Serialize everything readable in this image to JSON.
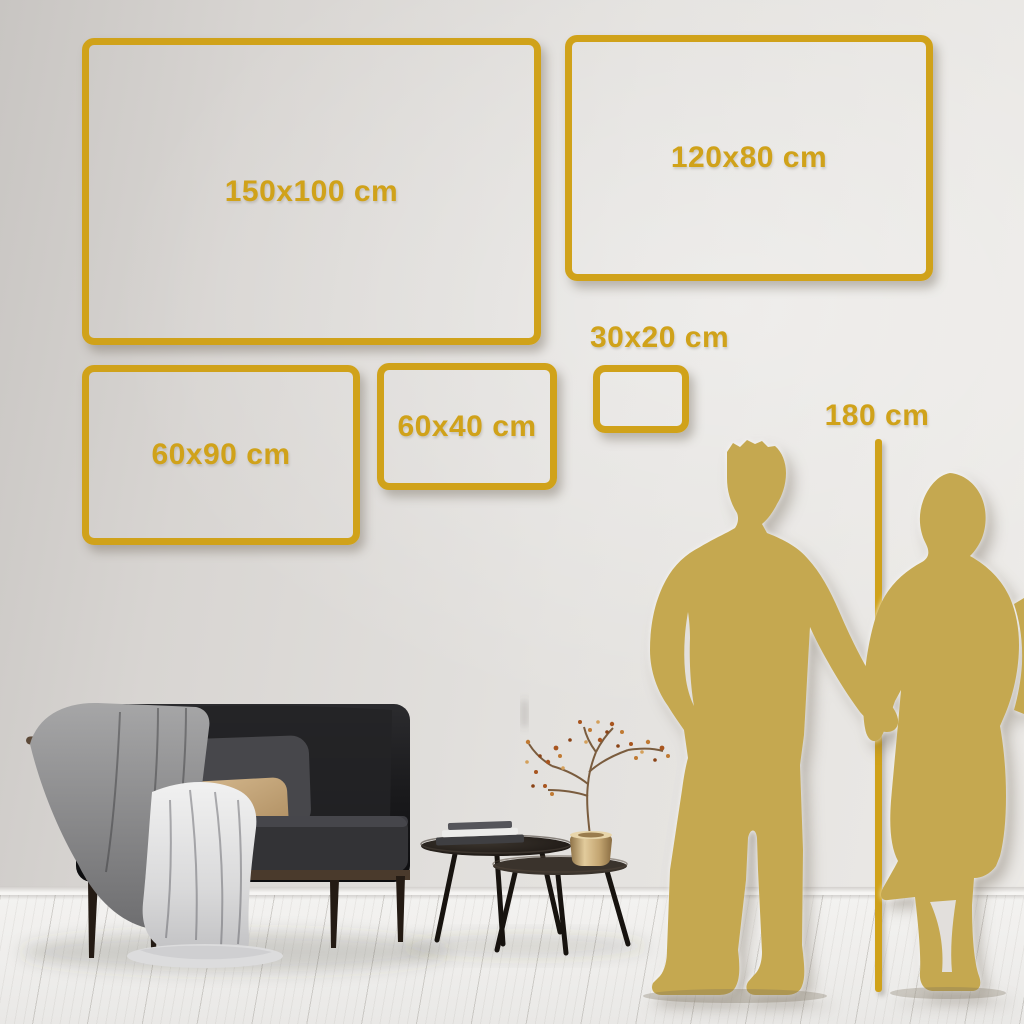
{
  "page": {
    "title": "Wall art size guide"
  },
  "size_guide": {
    "boxes": [
      {
        "label": "150x100 cm"
      },
      {
        "label": "120x80 cm"
      },
      {
        "label": "60x90 cm"
      },
      {
        "label": "60x40 cm"
      },
      {
        "label": "30x20 cm"
      }
    ],
    "height_marker": {
      "label": "180 cm"
    }
  },
  "colors": {
    "accent_gold": "#d0a21a",
    "silhouette_gold": "#c5a850",
    "wall": "#dedbd8",
    "floor": "#f0efed"
  },
  "scene": {
    "objects": [
      "dark sofa with gray blanket and beige pillow",
      "two round nesting coffee tables with books",
      "brass vase with dried berry branch",
      "couple silhouette holding hands",
      "white plank floor"
    ]
  }
}
